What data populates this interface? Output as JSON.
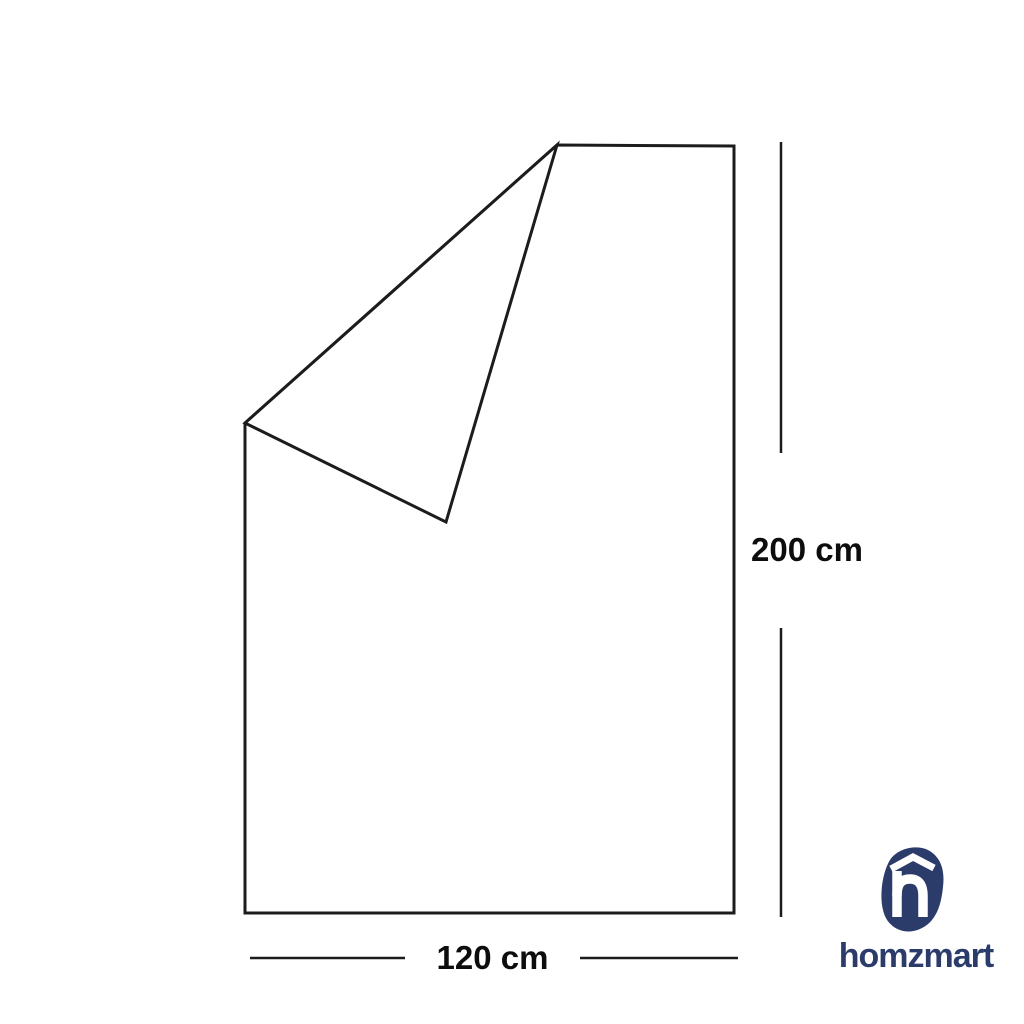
{
  "canvas": {
    "width": 1024,
    "height": 1024,
    "background": "#ffffff"
  },
  "diagram": {
    "type": "product-dimension-diagram",
    "subject": "sheet-with-folded-corner-outline",
    "line_color": "#1c1c1c",
    "height_dimension": {
      "label": "200 cm"
    },
    "width_dimension": {
      "label": "120 cm"
    }
  },
  "brand": {
    "name": "homzmart",
    "color": "#2b3c6b",
    "icon": "h-with-roof-pebble"
  }
}
